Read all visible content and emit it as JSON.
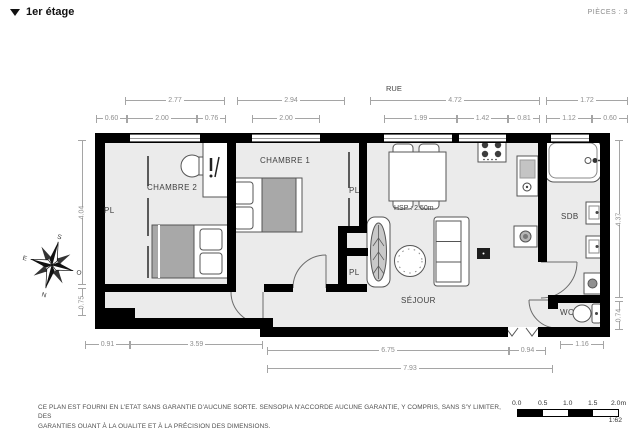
{
  "header": {
    "title": "1er étage",
    "pieces": "PIÈCES : 3"
  },
  "plan": {
    "street": "RUE",
    "hsp": "HSP : 2.50m",
    "rooms": {
      "chambre1": "CHAMBRE 1",
      "chambre2": "CHAMBRE 2",
      "sejour": "SÉJOUR",
      "sdb": "SDB",
      "wc": "WC",
      "pl": "PL"
    },
    "compass": {
      "n": "N",
      "s": "S",
      "e": "E",
      "o": "O"
    },
    "dims": {
      "top1": [
        "2.77",
        "2.94",
        "4.72",
        "1.72"
      ],
      "top2": [
        "0.60",
        "2.00",
        "0.76",
        "2.00",
        "1.99",
        "1.42",
        "0.81",
        "1.12",
        "0.60"
      ],
      "left": [
        "4.04",
        "0.75"
      ],
      "right": [
        "4.37",
        "0.74"
      ],
      "bottom": [
        "0.91",
        "3.59",
        "6.75",
        "0.94",
        "1.16",
        "7.93"
      ]
    }
  },
  "footer": {
    "line1": "CE PLAN EST FOURNI EN L'ETAT SANS GARANTIE D'AUCUNE SORTE. SENSOPIA N'ACCORDE AUCUNE GARANTIE, Y COMPRIS, SANS S'Y LIMITER, DES",
    "line2": "GARANTIES QUANT À LA QUALITE ET À LA PRÉCISION DES DIMENSIONS.",
    "scale": {
      "ticks": [
        "0.0",
        "0.5",
        "1.0",
        "1.5",
        "2.0m"
      ],
      "ratio": "1:62"
    }
  },
  "colors": {
    "wall": "#000000",
    "floor": "#ebebeb",
    "dim": "#8f8f8f",
    "label": "#3f3f3f"
  }
}
